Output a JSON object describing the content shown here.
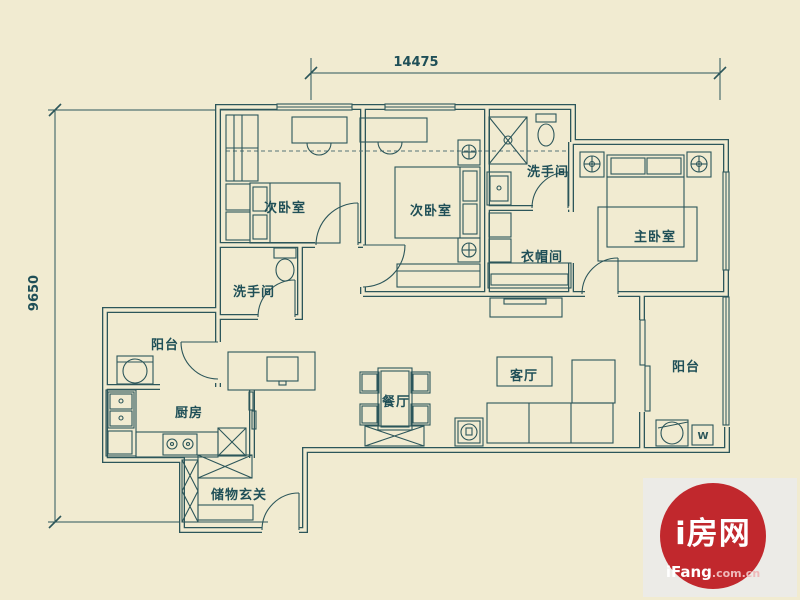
{
  "dimensions": {
    "top_width": "14475",
    "left_height": "9650"
  },
  "rooms": {
    "bedroom_left": "次卧室",
    "bedroom_mid": "次卧室",
    "bath_left": "洗手间",
    "bath_top": "洗手间",
    "cloakroom": "衣帽间",
    "master_bedroom": "主卧室",
    "balcony_left": "阳台",
    "balcony_right": "阳台",
    "kitchen": "厨房",
    "dining": "餐厅",
    "living": "客厅",
    "entry": "储物玄关"
  },
  "appliances": {
    "water_heater_label": "W"
  },
  "watermark": {
    "brand": "i房网",
    "site_name": "iFang",
    "site_suffix": ".com.cn"
  },
  "colors": {
    "background": "#f1ebd1",
    "line": "#2c565a",
    "label_text": "#1f4f57",
    "logo_red": "#c1282d",
    "logo_square": "#ecebe7",
    "logo_suffix_pink": "#efb9ba"
  }
}
